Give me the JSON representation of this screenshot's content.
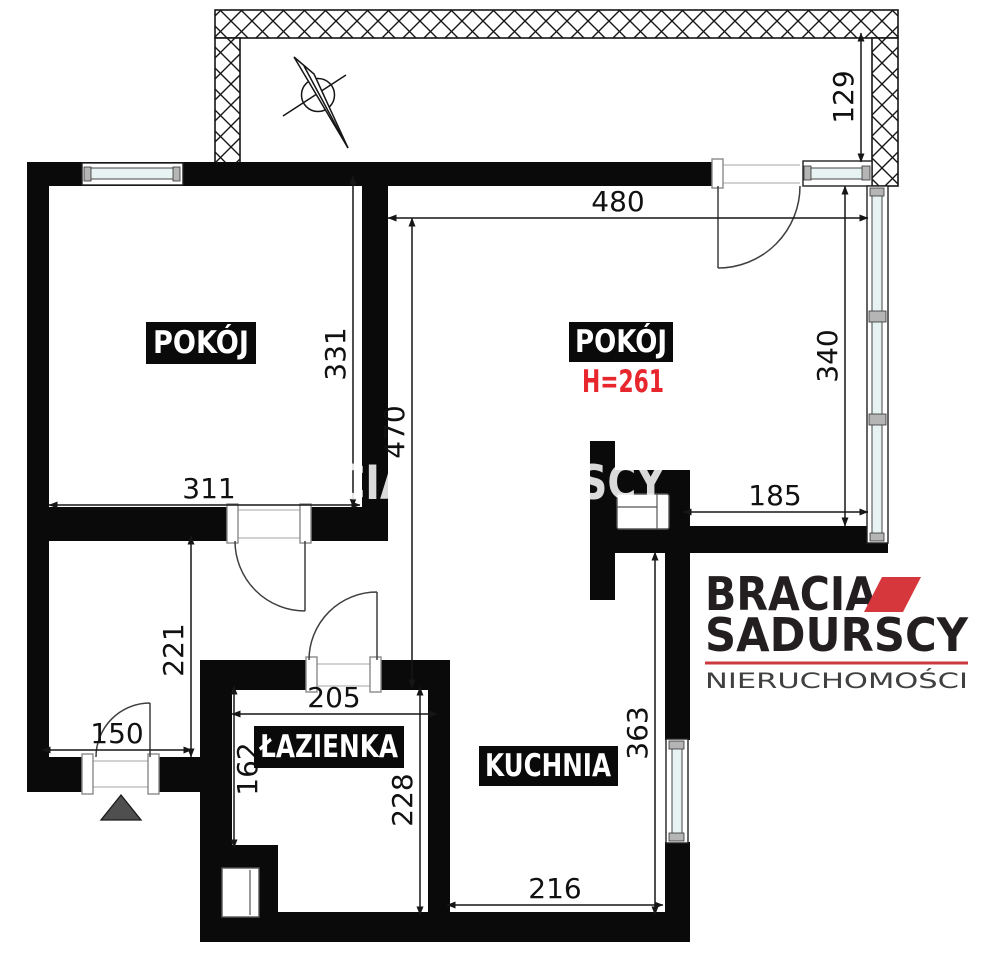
{
  "colors": {
    "wall": "#0a0a0a",
    "glass": "#e7f3f3",
    "accent_red": "#d6373c",
    "line_red": "#c9393f",
    "height_red": "#e8262d",
    "watermark": "rgba(255,255,255,0.85)",
    "entrance": "#4f4f4f"
  },
  "rooms": [
    {
      "id": "room-left",
      "label": "POKÓJ"
    },
    {
      "id": "room-right",
      "label": "POKÓJ",
      "height": "H=261"
    },
    {
      "id": "bathroom",
      "label": "ŁAZIENKA"
    },
    {
      "id": "kitchen",
      "label": "KUCHNIA"
    }
  ],
  "dimensions": {
    "d480": "480",
    "d129": "129",
    "d331": "331",
    "d470": "470",
    "d340": "340",
    "d185": "185",
    "d311": "311",
    "d221": "221",
    "d150": "150",
    "d205": "205",
    "d162": "162",
    "d228": "228",
    "d363": "363",
    "d216": "216"
  },
  "watermark": "BRACIA SADURSCY",
  "logo": {
    "brand_top": "BRACIA",
    "brand_bottom": "SADURSCY",
    "tagline": "NIERUCHOMOŚCI"
  }
}
